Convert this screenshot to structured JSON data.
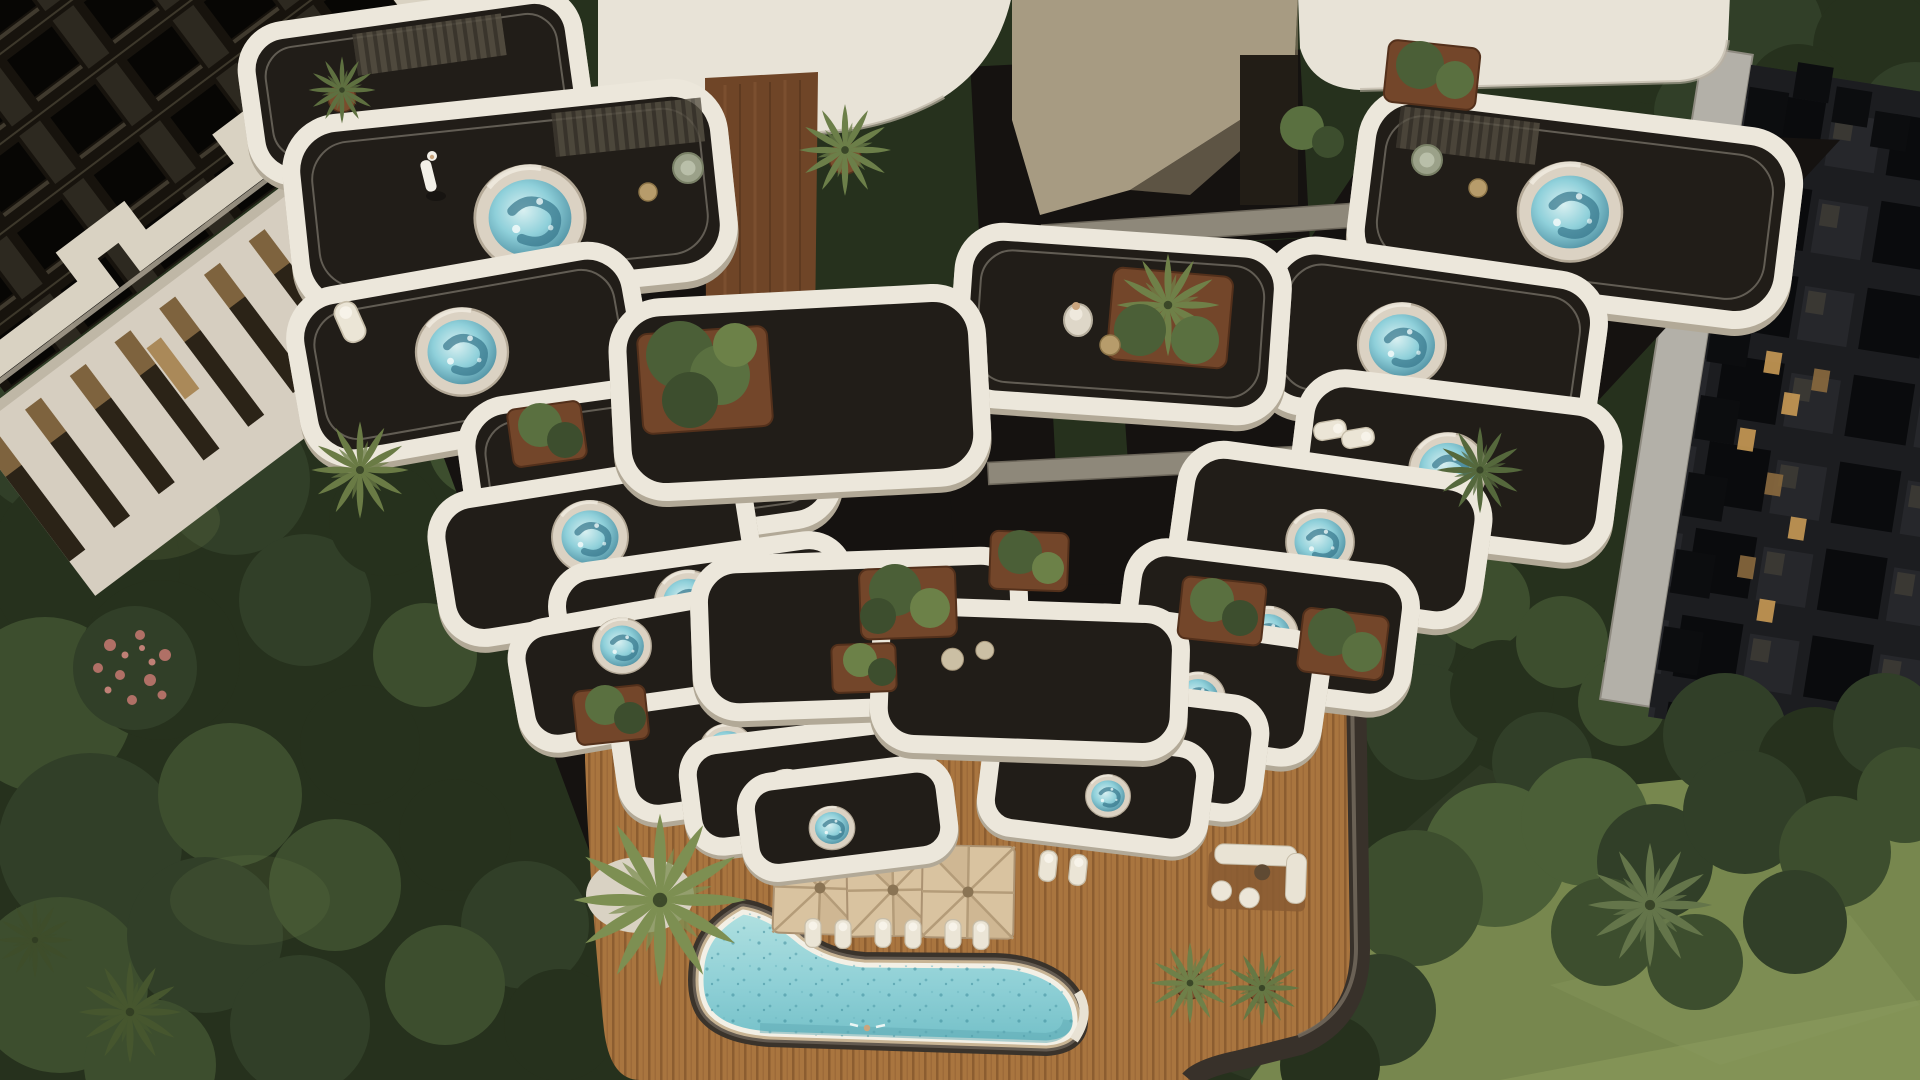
{
  "scene": {
    "type": "aerial-architectural-render",
    "view": "top-down drone view, daylight",
    "aria_label": "Top-down aerial render of a luxury residential tower with cascading white balconies, private round jacuzzis, rust planters full of greenery, a free-form turquoise pool on a timber deck with beige umbrellas and loungers, surrounded by dense trees, lawns and two neighboring apartment buildings"
  },
  "palette": {
    "foliage_dark": "#26311d",
    "foliage_mid": "#3d4e2e",
    "foliage_light": "#5a7040",
    "lawn": "#77874e",
    "lawn_sunlit": "#93a363",
    "canopy_white": "#e8e3d7",
    "balcony_white": "#ece7db",
    "glass_floor": "#211d18",
    "planter_rust": "#73462a",
    "rust_wall": "#6f4527",
    "deck_wood": "#a9753f",
    "pool_water": "#8fd0d6",
    "tub_water": "#7ec6d2",
    "umbrella_beige": "#d9c3a0",
    "pool_rim_dark": "#38312a",
    "neighbor_left_facade": "#d6cec0",
    "neighbor_right_facade": "#1c1d20",
    "lit_window": "#c89a55"
  },
  "inventory": {
    "buildings": 3,
    "hero_tower_jacuzzis": 17,
    "pool_count": 1,
    "umbrellas": 3,
    "sun_loungers": 10,
    "armchairs": 2,
    "planters": 14,
    "palm_trees": 10,
    "people": 3,
    "people_list": [
      "man-in-white-kandura-standing-on-balcony",
      "woman-seated-on-balcony",
      "swimmer-in-pool"
    ]
  }
}
